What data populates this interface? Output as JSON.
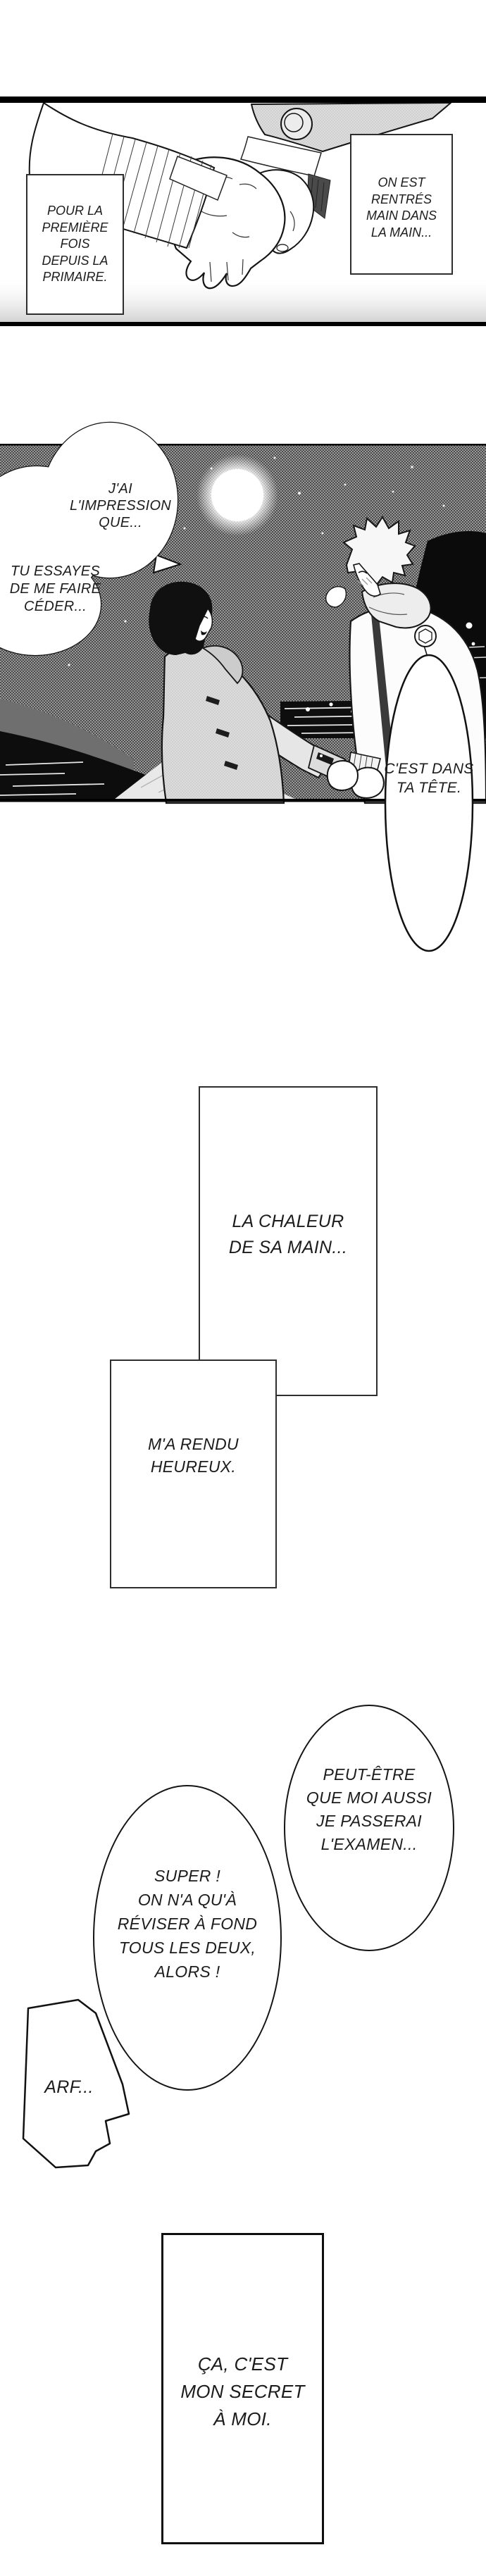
{
  "colors": {
    "ink": "#141414",
    "paper": "#ffffff",
    "night_sky": "#9d9d9d"
  },
  "panel1": {
    "caption_left": {
      "lines": [
        "POUR LA",
        "PREMIÈRE FOIS",
        "DEPUIS LA",
        "PRIMAIRE."
      ]
    },
    "caption_right": {
      "lines": [
        "ON EST",
        "RENTRÉS",
        "MAIN DANS",
        "LA MAIN..."
      ]
    }
  },
  "panel2": {
    "bubble_impression": {
      "lines": [
        "J'AI",
        "L'IMPRESSION",
        "QUE..."
      ]
    },
    "bubble_essayes": {
      "lines": [
        "TU ESSAYES",
        "DE ME FAIRE",
        "CÉDER..."
      ]
    },
    "bubble_tete": {
      "lines": [
        "C'EST DANS",
        "TA TÊTE."
      ]
    }
  },
  "captions": {
    "chaleur": {
      "lines": [
        "LA CHALEUR",
        "DE SA MAIN..."
      ]
    },
    "heureux": {
      "lines": [
        "M'A RENDU",
        "HEUREUX."
      ]
    },
    "secret": {
      "lines": [
        "ÇA, C'EST",
        "MON SECRET",
        "À MOI."
      ]
    }
  },
  "bubbles": {
    "examen": {
      "lines": [
        "PEUT-ÊTRE",
        "QUE MOI AUSSI",
        "JE PASSERAI",
        "L'EXAMEN..."
      ]
    },
    "super": {
      "lines": [
        "SUPER !",
        "ON N'A QU'À",
        "RÉVISER À FOND",
        "TOUS LES DEUX,",
        "ALORS !"
      ]
    },
    "arf": {
      "text": "ARF..."
    }
  }
}
